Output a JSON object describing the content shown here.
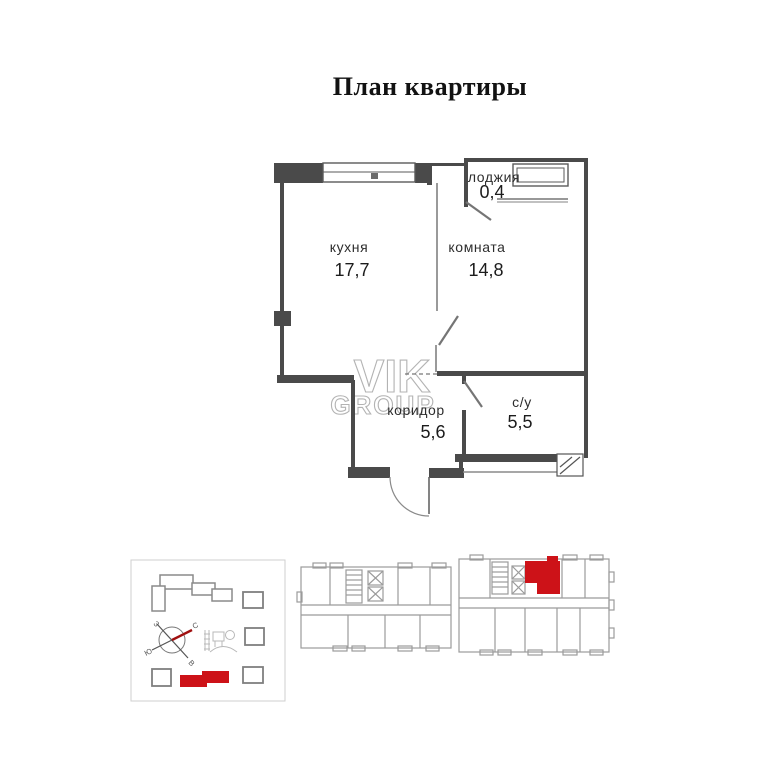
{
  "page": {
    "title": "План квартиры"
  },
  "watermark": {
    "line1": "VIK",
    "line2": "GROUP"
  },
  "apartment": {
    "rooms": [
      {
        "name": "кухня",
        "area": "17,7"
      },
      {
        "name": "комната",
        "area": "14,8"
      },
      {
        "name": "лоджия",
        "area": "0,4"
      },
      {
        "name": "коридор",
        "area": "5,6"
      },
      {
        "name": "с/у",
        "area": "5,5"
      }
    ]
  },
  "site_plan": {
    "compass": {
      "west": "З",
      "north": "С",
      "east": "В",
      "south": "Ю"
    }
  },
  "colors": {
    "wall": "#4a4a4a",
    "light_plan": "#9b9b9b",
    "accent_red": "#cd1218",
    "compass_needle": "#a01010"
  }
}
